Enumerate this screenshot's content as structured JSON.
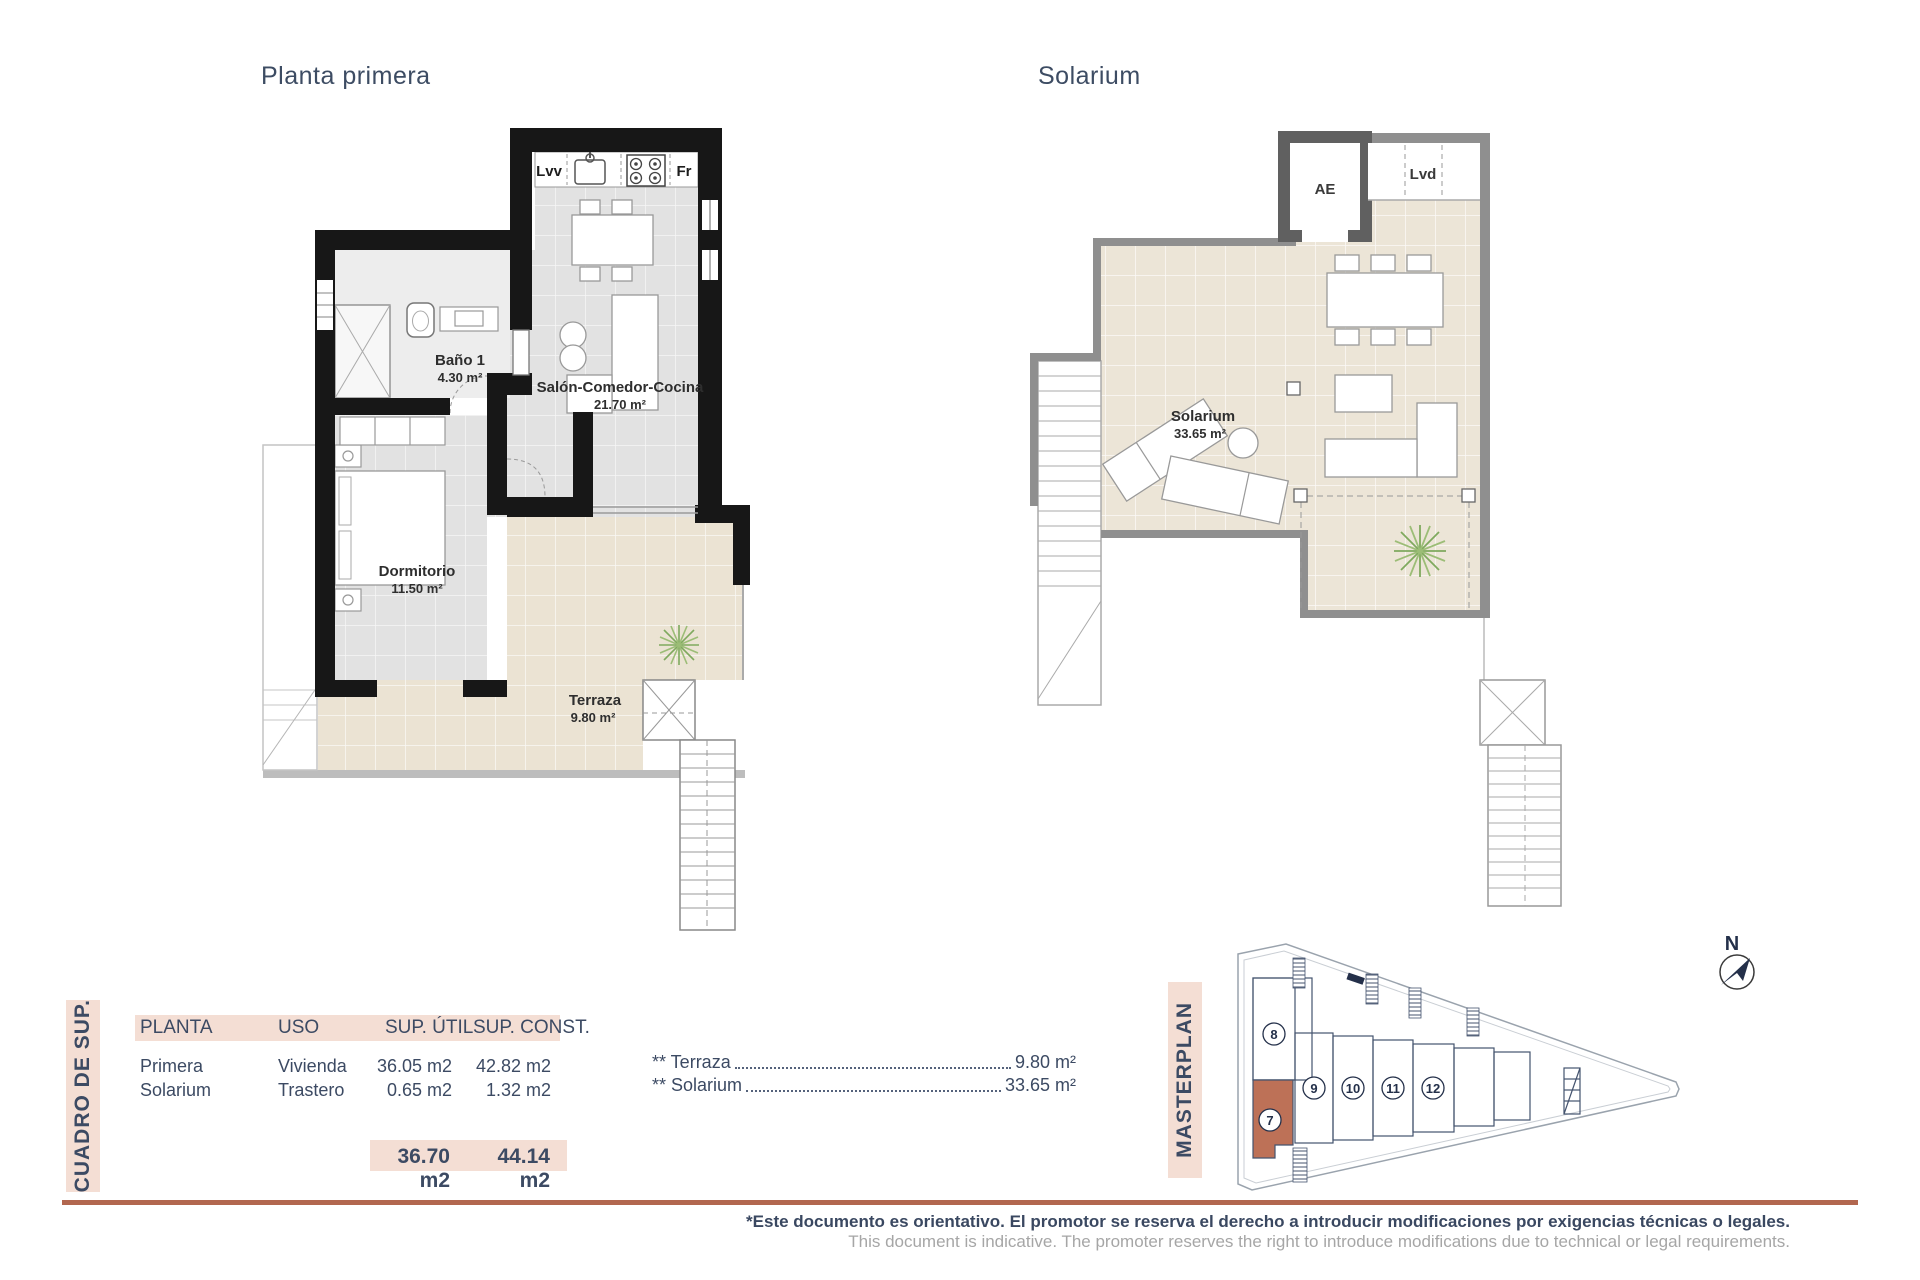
{
  "plan1": {
    "title": "Planta primera",
    "kitchen": {
      "lvv": "Lvv",
      "fr": "Fr"
    },
    "rooms": [
      {
        "name": "Baño 1",
        "area": "4.30 m²"
      },
      {
        "name": "Salón-Comedor-Cocina",
        "area": "21.70 m²"
      },
      {
        "name": "Dormitorio",
        "area": "11.50 m²"
      },
      {
        "name": "Terraza",
        "area": "9.80 m²"
      }
    ]
  },
  "plan2": {
    "title": "Solarium",
    "room": {
      "name": "Solarium",
      "area": "33.65 m²"
    },
    "ae_label": "AE",
    "lvd_label": "Lvd"
  },
  "summary": {
    "side_label": "CUADRO DE SUP.",
    "headers": {
      "planta": "PLANTA",
      "uso": "USO",
      "util": "SUP. ÚTIL",
      "const": "SUP. CONST."
    },
    "rows": [
      {
        "planta": "Primera",
        "uso": "Vivienda",
        "util": "36.05 m2",
        "const": "42.82 m2"
      },
      {
        "planta": "Solarium",
        "uso": "Trastero",
        "util": "0.65 m2",
        "const": "1.32 m2"
      }
    ],
    "totals": {
      "util": "36.70 m2",
      "const": "44.14 m2"
    },
    "annotations": [
      {
        "label": "** Terraza",
        "value": "9.80 m²"
      },
      {
        "label": "** Solarium",
        "value": "33.65 m²"
      }
    ]
  },
  "masterplan": {
    "side_label": "MASTERPLAN",
    "north_label": "N",
    "units": [
      "8",
      "9",
      "10",
      "11",
      "12"
    ],
    "highlighted_unit": "7"
  },
  "footer": {
    "line1": "*Este documento es orientativo. El promotor se reserva el derecho a introducir modificaciones por exigencias técnicas o legales.",
    "line2": "This document is indicative. The promoter reserves the right to introduce modifications due to technical or legal requirements."
  },
  "colors": {
    "navy": "#3c4a63",
    "pink": "#f4ded4",
    "terracotta": "#b2674f",
    "unit7_fill": "#bd7157"
  }
}
